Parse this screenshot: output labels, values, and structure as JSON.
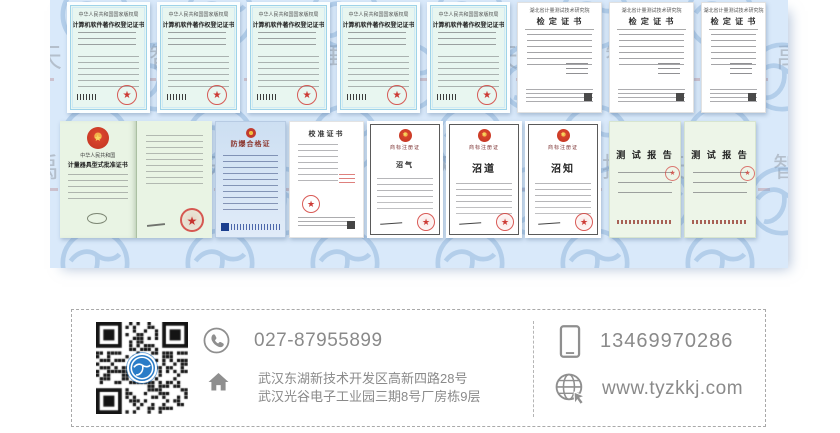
{
  "watermark": {
    "text": "天禹智控",
    "logo_color": "#7fa9d6"
  },
  "certificates": {
    "top": [
      {
        "type": "software-copyright",
        "header": "中华人民共和国国家版权局",
        "title": "计算机软件著作权登记证书"
      },
      {
        "type": "software-copyright",
        "header": "中华人民共和国国家版权局",
        "title": "计算机软件著作权登记证书"
      },
      {
        "type": "software-copyright",
        "header": "中华人民共和国国家版权局",
        "title": "计算机软件著作权登记证书"
      },
      {
        "type": "software-copyright",
        "header": "中华人民共和国国家版权局",
        "title": "计算机软件著作权登记证书"
      },
      {
        "type": "software-copyright",
        "header": "中华人民共和国国家版权局",
        "title": "计算机软件著作权登记证书"
      },
      {
        "type": "verification",
        "header": "湖北省计量测试技术研究院",
        "title": "检 定 证 书"
      },
      {
        "type": "verification",
        "header": "湖北省计量测试技术研究院",
        "title": "检 定 证 书"
      },
      {
        "type": "verification",
        "header": "湖北省计量测试技术研究院",
        "title": "检 定 证 书"
      }
    ],
    "bottom": [
      {
        "type": "pattern-approval",
        "country": "中华人民共和国",
        "title": "计量器具型式批准证书"
      },
      {
        "type": "explosion-proof",
        "title": "防爆合格证"
      },
      {
        "type": "calibration",
        "title": "校准证书"
      },
      {
        "type": "trademark",
        "title": "商标注册证",
        "mark": "沼气"
      },
      {
        "type": "trademark",
        "title": "商标注册证",
        "mark": "沼道"
      },
      {
        "type": "trademark",
        "title": "商标注册证",
        "mark": "沼知"
      },
      {
        "type": "test-report",
        "title": "测 试 报 告"
      },
      {
        "type": "test-report",
        "title": "测 试 报 告"
      }
    ]
  },
  "contact": {
    "phone": "027-87955899",
    "mobile": "13469970286",
    "address_line1": "武汉东湖新技术开发区高新四路28号",
    "address_line2": "武汉光谷电子工业园三期8号厂房栋9层",
    "website": "www.tyzkkj.com"
  },
  "colors": {
    "panel_bg": "#d9e9fa",
    "logo_blue": "#2a7cc7",
    "text_gray": "#8a8a8a",
    "seal_red": "#cc3a35"
  }
}
